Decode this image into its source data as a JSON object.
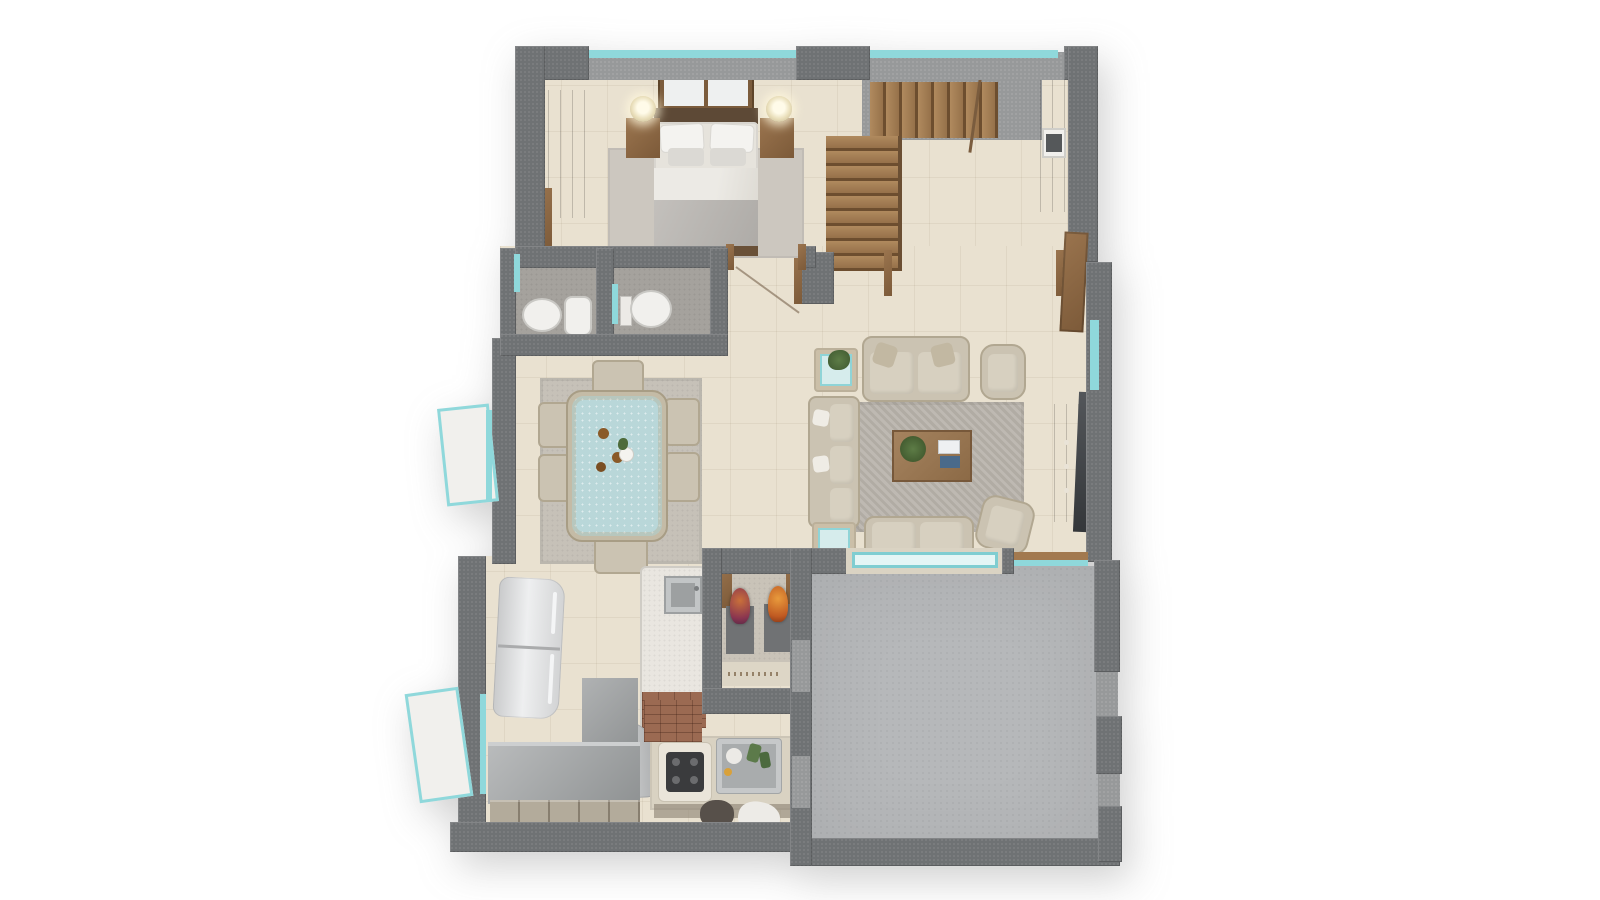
{
  "meta": {
    "description": "Photorealistic 3D top-down dollhouse render of a single-storey home floor plan on a plain white background; no legible text labels",
    "canvas": {
      "width": 1600,
      "height": 900
    }
  },
  "palette": {
    "background": "#ffffff",
    "wall_dark": "#6f7274",
    "wall_light": "#97999a",
    "floor_beige": "#e9e1d0",
    "bath_floor_gray": "#a5a29d",
    "patio_concrete": "#b6b8ba",
    "rug_gray": "#c6c1b8",
    "sofa_beige": "#cbc3b2",
    "wood_brown": "#8a6746",
    "stair_wood": "#a8825a",
    "window_teal": "#8fd8db",
    "dining_table_blue": "#b9d7d9",
    "fridge_silver": "#dcdddf",
    "counter_gray": "#9fa2a3",
    "counter_beige": "#d9d2c2",
    "cooktop_black": "#3a3b3d",
    "tv_dark": "#44474a",
    "plant_green": "#4e6b3a",
    "statue_orange": "#d27a30",
    "statue_red": "#a33d20",
    "fixture_white": "#f1f0ed",
    "brick": "#9b6a52"
  },
  "scene": {
    "style": "3d-floor-plan-render",
    "rooms": [
      {
        "id": "bedroom",
        "position": "top-left",
        "furniture": [
          "wardrobe",
          "dresser",
          "double-bed",
          "headboard",
          "headboard-window",
          "nightstand-left",
          "nightstand-right",
          "table-lamp-left",
          "table-lamp-right",
          "area-rug"
        ]
      },
      {
        "id": "bathroom-left",
        "position": "mid-left",
        "furniture": [
          "washbasin",
          "shower-tray",
          "teal-door"
        ]
      },
      {
        "id": "bathroom-right",
        "position": "mid-left",
        "furniture": [
          "toilet",
          "teal-door"
        ]
      },
      {
        "id": "stair-hall",
        "position": "top-right",
        "furniture": [
          "l-shaped-wood-staircase",
          "handrail",
          "newel-wall",
          "tall-cabinet",
          "built-in-appliance"
        ]
      },
      {
        "id": "dining-room",
        "position": "center-left",
        "furniture": [
          "dining-table-blue-top",
          "dining-chair x6",
          "area-rug",
          "plates",
          "vase"
        ]
      },
      {
        "id": "living-room",
        "position": "center-right",
        "furniture": [
          "loveseat-top",
          "loveseat-bottom",
          "armchair-top-right",
          "armchair-bottom-right",
          "corner-sectional",
          "coffee-table",
          "potted-plant",
          "books",
          "glass-side-table x2",
          "tv-console",
          "flat-tv",
          "area-rug",
          "entry-door"
        ]
      },
      {
        "id": "kitchen",
        "position": "bottom-left",
        "furniture": [
          "refrigerator",
          "island-with-sink",
          "brick-island-base",
          "chimney-hood",
          "l-shaped-gray-counter",
          "cabinet-fronts",
          "cooktop-counter",
          "sink-with-dishes",
          "brick-chimney"
        ]
      },
      {
        "id": "pooja-alcove",
        "position": "bottom-center",
        "furniture": [
          "deity-statue-left",
          "deity-statue-right",
          "statue-platform x2",
          "wood-shelf x2",
          "micro-text-band-illegible"
        ]
      },
      {
        "id": "patio",
        "position": "bottom-right",
        "furniture": []
      }
    ],
    "openings": [
      "top-window-strip x2",
      "left-open-casement-window x2",
      "bedroom-door-with-swing",
      "bathroom-teal-door x2",
      "east-entry-door",
      "patio-picture-window",
      "patio-rail-window",
      "east-glass-strip"
    ]
  }
}
